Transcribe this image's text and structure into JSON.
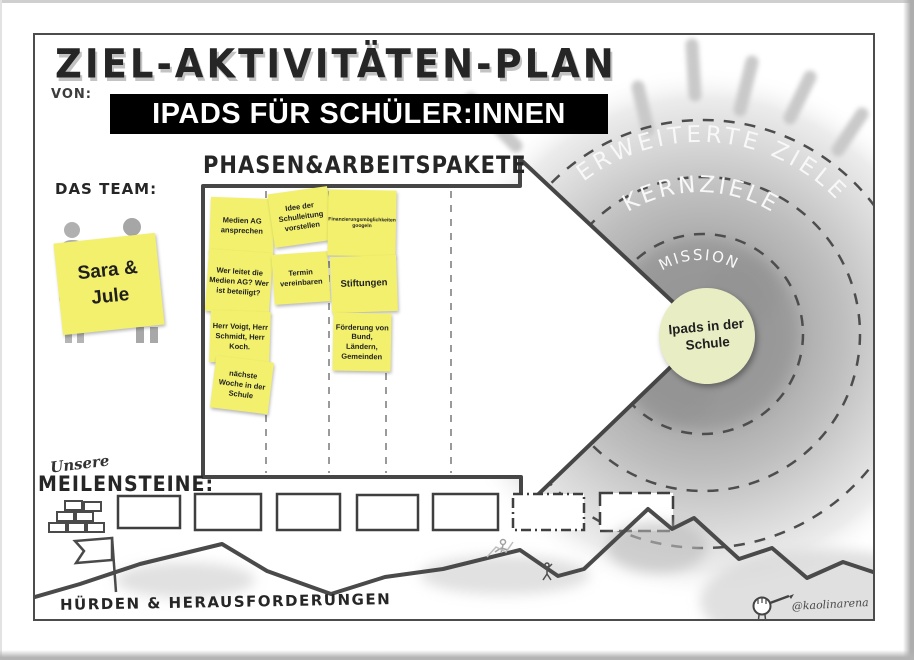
{
  "canvas": {
    "title": "ZIEL-AKTIVITÄTEN-PLAN",
    "von_label": "VON:",
    "project_banner": "IPADS FÜR SCHÜLER:INNEN",
    "watermark_handle": "@kaolinarena"
  },
  "team": {
    "label": "DAS TEAM:",
    "note": "Sara & Jule"
  },
  "phases": {
    "heading": "PHASEN&ARBEITSPAKETE",
    "columns": [
      {
        "notes": [
          "Medien AG ansprechen",
          "Wer leitet die Medien AG? Wer ist beteiligt?",
          "Herr Voigt, Herr Schmidt, Herr Koch.",
          "nächste Woche in der Schule"
        ]
      },
      {
        "notes": [
          "Idee der Schulleitung vorstellen",
          "Termin vereinbaren"
        ]
      },
      {
        "notes": [
          "Finanzierungsmöglichkeiten googeln",
          "Stiftungen",
          "Förderung von Bund, Ländern, Gemeinden"
        ]
      }
    ]
  },
  "goal": {
    "ring_outer": "ERWEITERTE ZIELE",
    "ring_middle": "KERNZIELE",
    "ring_inner": "MISSION",
    "core_note": "Ipads in der Schule"
  },
  "milestones": {
    "label_script": "Unsere",
    "label": "MEILENSTEINE:",
    "box_count": 7
  },
  "hurdles": {
    "label": "HÜRDEN & HERAUSFORDERUNGEN"
  },
  "colors": {
    "sticky_yellow": "#f2f06c",
    "core_note_green": "#e9edc3",
    "ink": "#4a4a4a",
    "banner_bg": "#000000",
    "banner_text": "#ffffff",
    "wash_gray": "#b5b5b5"
  }
}
